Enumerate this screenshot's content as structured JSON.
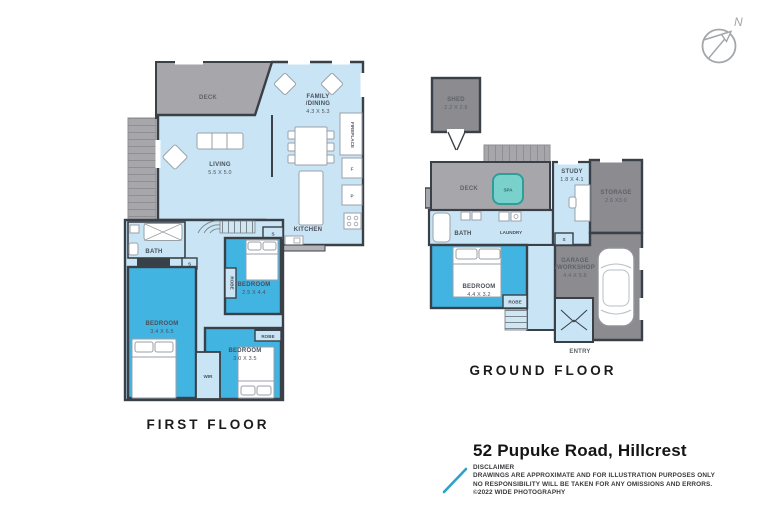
{
  "compass": {
    "north_label": "N"
  },
  "first_floor": {
    "caption": "FIRST FLOOR",
    "labels": {
      "deck": "DECK",
      "living_name": "LIVING",
      "living_dims": "5.5 X 5.0",
      "family_line1": "FAMILY",
      "family_line2": "/DINING",
      "family_dims": "4.3 X 5.3",
      "kitchen": "KITCHEN",
      "fireplace": "FIREPLACE",
      "fridge": "F",
      "pantry": "P",
      "bath": "BATH",
      "cupboard_hall": "S",
      "cupboard_kitchen": "S",
      "bedroom1_name": "BEDROOM",
      "bedroom1_dims": "3.4 X 6.5",
      "bedroom2_name": "BEDROOM",
      "bedroom2_dims": "2.5 X 4.4",
      "bedroom2_robe": "ROBE",
      "bedroom3_name": "BEDROOM",
      "bedroom3_dims": "3.0 X 3.5",
      "bedroom3_robe": "ROBE",
      "wir": "WIR"
    }
  },
  "ground_floor": {
    "caption": "GROUND FLOOR",
    "labels": {
      "shed_name": "SHED",
      "shed_dims": "2.2 X 2.6",
      "deck": "DECK",
      "spa": "SPA",
      "study_name": "STUDY",
      "study_dims": "1.8 X 4.1",
      "storage_name": "STORAGE",
      "storage_dims": "2.6 X3.0",
      "bath": "BATH",
      "laundry": "LAUNDRY",
      "cupboard": "S",
      "bedroom_name": "BEDROOM",
      "bedroom_dims": "4.4 X 3.2",
      "robe": "ROBE",
      "garage_line1": "GARAGE",
      "garage_line2": "/WORKSHOP",
      "garage_dims": "4.4 X 5.8",
      "entry": "ENTRY"
    }
  },
  "title_block": {
    "address": "52 Pupuke Road, Hillcrest",
    "disclaimer_heading": "DISCLAIMER",
    "disclaimer_line1": "DRAWINGS ARE APPROXIMATE AND FOR ILLUSTRATION PURPOSES ONLY",
    "disclaimer_line2": "NO RESPONSIBILITY WILL BE TAKEN FOR ANY OMISSIONS AND ERRORS.",
    "disclaimer_line3": "©2022 WIDE PHOTOGRAPHY"
  },
  "colors": {
    "room_light": "#c9e5f5",
    "room_accent": "#42b4e2",
    "deck_gray": "#a7a7ab",
    "outbuilding_gray": "#8b8b90",
    "wall": "#3a4047",
    "spa_teal": "#7ad1cb",
    "logo_teal": "#29a3c9"
  }
}
